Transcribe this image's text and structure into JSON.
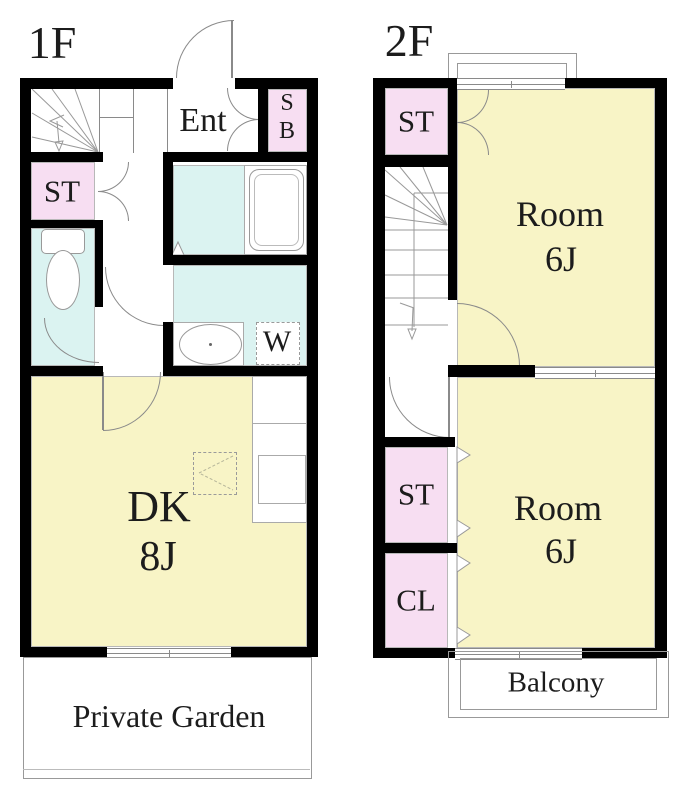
{
  "plan": {
    "floor1": {
      "title": "1F",
      "labels": {
        "ent": "Ent",
        "shoebox_top": "S",
        "shoebox_bottom": "B",
        "storage": "ST",
        "dk_name": "DK",
        "dk_size": "8J",
        "washer": "W",
        "garden": "Private Garden"
      }
    },
    "floor2": {
      "title": "2F",
      "labels": {
        "storage_top": "ST",
        "room1_name": "Room",
        "room1_size": "6J",
        "storage": "ST",
        "closet": "CL",
        "room2_name": "Room",
        "room2_size": "6J",
        "balcony": "Balcony"
      }
    },
    "colors": {
      "wall": "#000000",
      "line": "#8A8A8A",
      "text": "#1C1C1C",
      "room_yellow": "#F8F4C6",
      "closet_pink": "#F7DEF2",
      "wet_cyan": "#DBF3F1"
    }
  }
}
